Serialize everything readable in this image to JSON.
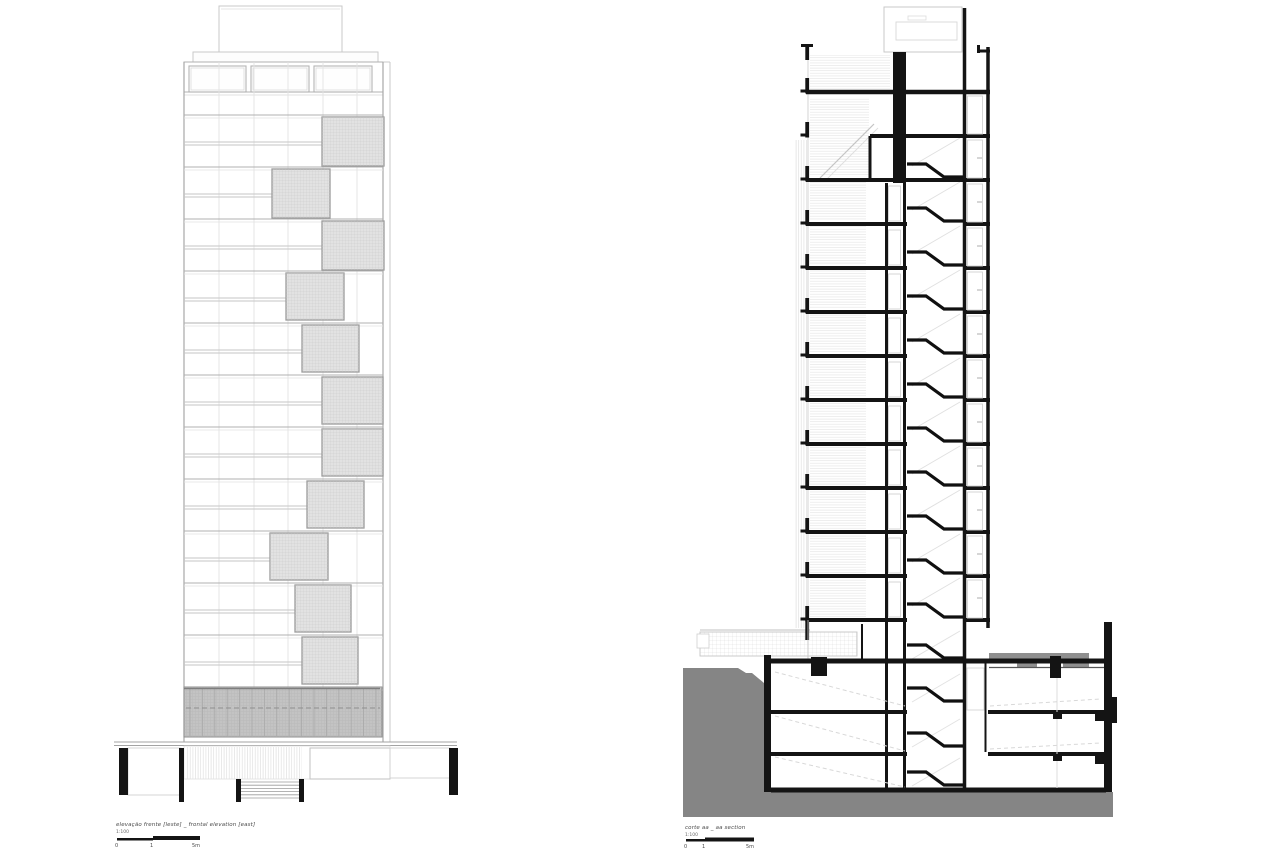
{
  "colors": {
    "ink": "#141414",
    "edge": "#9c9c9c",
    "panel_fill": "#e2e2e2",
    "band_fill": "#c3c3c3",
    "earth": "#858585",
    "gray_block": "#8f8f8f",
    "line_strong": "#a8a8a8",
    "line_mid": "#c6c6c6",
    "line_faint": "#e3e3e3"
  },
  "elevation": {
    "caption": "elevação frente [leste] _ frontal elevation [east]",
    "scale_label": "1:100",
    "ticks": [
      "0",
      "1",
      "5m"
    ],
    "frame": {
      "l": 184,
      "r": 383,
      "rr": 390,
      "top": 62,
      "bot": 742
    },
    "roof_box": [
      219,
      6,
      123,
      47
    ],
    "parapet": [
      193,
      52,
      185,
      10
    ],
    "windows": [
      [
        189,
        66,
        57,
        26
      ],
      [
        251,
        66,
        58,
        26
      ],
      [
        314,
        66,
        58,
        26
      ]
    ],
    "band_lines": [
      92,
      95
    ],
    "floors": [
      115,
      167,
      219,
      271,
      323,
      375,
      427,
      479,
      531,
      583,
      635,
      687
    ],
    "mullions": [
      219,
      254,
      288,
      323,
      357
    ],
    "mid_off": [
      27,
      30
    ],
    "panels": [
      [
        322,
        117,
        62,
        49
      ],
      [
        272,
        169,
        58,
        49
      ],
      [
        322,
        221,
        62,
        49
      ],
      [
        286,
        273,
        58,
        47
      ],
      [
        302,
        325,
        57,
        47
      ],
      [
        322,
        377,
        61,
        47
      ],
      [
        322,
        429,
        61,
        47
      ],
      [
        307,
        481,
        57,
        47
      ],
      [
        270,
        533,
        58,
        47
      ],
      [
        295,
        585,
        56,
        47
      ],
      [
        302,
        637,
        56,
        47
      ]
    ],
    "base_band": {
      "x": 184,
      "y": 687,
      "w": 198,
      "h": 50,
      "step": 12.4,
      "dash_y": 708
    },
    "plinth": {
      "y": [
        742,
        745.5
      ],
      "x1": 114,
      "x2": 457
    },
    "hatch": [
      186,
      747,
      116,
      32
    ],
    "opening": [
      310,
      748,
      80,
      31
    ],
    "boxes": [
      [
        128,
        748,
        53,
        47
      ],
      [
        390,
        748,
        60,
        30
      ]
    ],
    "columns": [
      [
        119,
        748,
        9,
        47
      ],
      [
        179,
        748,
        5,
        54
      ],
      [
        236,
        779,
        5,
        23
      ],
      [
        299,
        779,
        5,
        23
      ],
      [
        449,
        748,
        9,
        47
      ]
    ],
    "stairs": {
      "x1": 241,
      "x2": 299,
      "y": 782,
      "n": 6,
      "dy": 3.2
    },
    "caption_pos": [
      116,
      822
    ],
    "scalebar": {
      "bars": [
        [
          117,
          838,
          36,
          2.5
        ],
        [
          153,
          836,
          47,
          4
        ]
      ],
      "tick_x": [
        115,
        150,
        192
      ],
      "tick_y": 843
    }
  },
  "section": {
    "caption": "corte aa _ aa section",
    "scale_label": "1:100",
    "ticks": [
      "0",
      "1",
      "5m"
    ],
    "x": {
      "hatch": 794,
      "face": 808,
      "wall": 805.3,
      "rooms_l": 810,
      "stub": 870,
      "core_a": 893,
      "core_w": 13,
      "wall_a": 886.5,
      "wall_b": 904.5,
      "stair_l": 907,
      "stair_r": 963,
      "core_r": 964.5,
      "face_r": 988,
      "right_wall": 1104,
      "right_extent": 990
    },
    "levels": {
      "parapet": 44,
      "roof": 92,
      "mezz": 136,
      "typ0": 180,
      "dy": 44,
      "n": 11,
      "base": 628,
      "ground": 661,
      "b1": 712,
      "b2": 754,
      "b3": 790,
      "earth_bot": 817
    },
    "roof_box": [
      884,
      7,
      78,
      45
    ],
    "tank": [
      896,
      22,
      61,
      18
    ],
    "deck": [
      700,
      632,
      157,
      24
    ],
    "deck_notch": [
      697,
      634,
      12,
      14
    ],
    "earth": [
      [
        683,
        668
      ],
      [
        738,
        668
      ],
      [
        746,
        673
      ],
      [
        752,
        673
      ],
      [
        758,
        678
      ],
      [
        764,
        683
      ],
      [
        764,
        792
      ],
      [
        1113,
        792
      ],
      [
        1113,
        817
      ],
      [
        683,
        817
      ]
    ],
    "gray_blocks": [
      [
        989,
        653,
        100,
        6
      ],
      [
        1017,
        653,
        20,
        15
      ],
      [
        1063,
        653,
        26,
        15
      ]
    ],
    "black_rects": [
      [
        811,
        657,
        16,
        19
      ],
      [
        764,
        655,
        7,
        137
      ],
      [
        1104,
        622,
        8,
        170
      ],
      [
        1110,
        697,
        7,
        26
      ],
      [
        1050,
        656,
        11,
        22
      ],
      [
        1053,
        712,
        9,
        7
      ],
      [
        1053,
        754,
        9,
        7
      ],
      [
        1095,
        712,
        9,
        9
      ],
      [
        1095,
        756,
        9,
        8
      ]
    ],
    "stair_extra": [
      661,
      704,
      749,
      788
    ],
    "ramps": [
      [
        775,
        672,
        905,
        706
      ],
      [
        775,
        716,
        905,
        751
      ],
      [
        775,
        757,
        905,
        787
      ],
      [
        990,
        706,
        1100,
        699
      ],
      [
        990,
        749,
        1100,
        743
      ]
    ],
    "caption_pos": [
      685,
      825
    ],
    "scalebar": {
      "bars": [
        [
          686,
          839,
          19,
          2.5
        ],
        [
          705,
          837.5,
          49,
          4
        ]
      ],
      "tick_x": [
        684,
        702,
        746
      ],
      "tick_y": 844
    }
  }
}
